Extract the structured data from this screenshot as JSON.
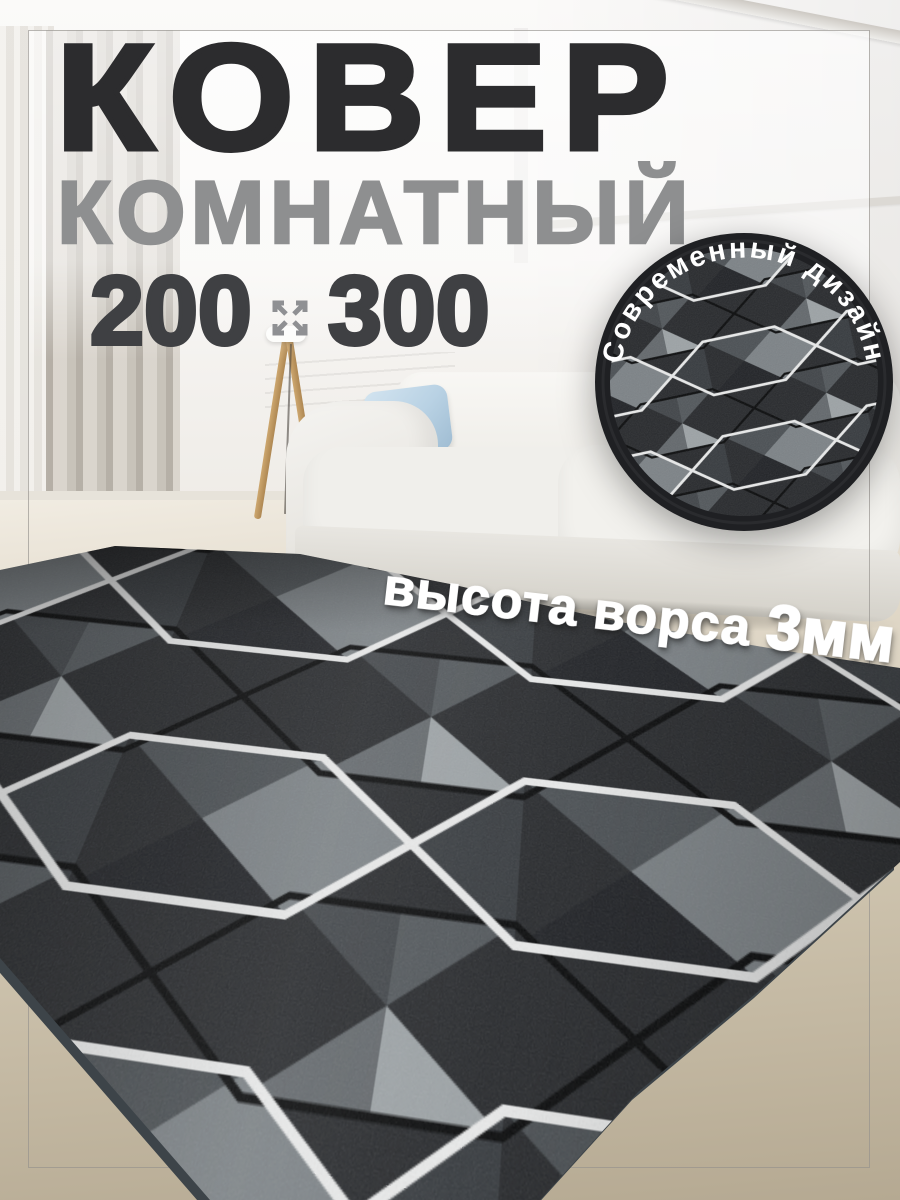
{
  "header": {
    "title": "КОВЕР",
    "subtitle": "КОМНАТНЫЙ"
  },
  "size_row": {
    "width_value": "200",
    "height_value": "300",
    "icon": "expand-arrows-icon"
  },
  "badge": {
    "label": "Современный дизайн"
  },
  "pile": {
    "label": "высота ворса ",
    "value": "3мм"
  },
  "colors": {
    "title_text": "#2c2c2e",
    "subtitle_text": "#8e8f90",
    "size_text": "#3f4043",
    "badge_ring": "#1f2023",
    "badge_text": "#ffffff",
    "pile_text": "#ffffff",
    "carpet_base": "#292b2e",
    "carpet_outline_light": "#e9eaea",
    "carpet_outline_dark": "#0b0c0d",
    "sofa": "#f0efeb",
    "pillow": "#bdd5e7",
    "floor": "#d9d0bd",
    "wall": "#f5f4f2",
    "curtain": "#c6c1b8"
  }
}
